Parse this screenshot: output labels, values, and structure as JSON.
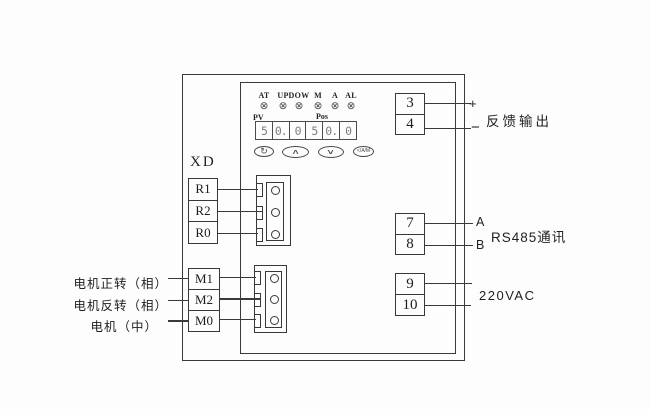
{
  "diagram": {
    "xd_label": "XD",
    "led_glyph": "⊗",
    "indicators": [
      "AT",
      "UP",
      "DOW",
      "M",
      "A",
      "AL"
    ],
    "display": {
      "pv_label": "PV",
      "pos_label": "Pos",
      "digits": [
        "5",
        "0.",
        "0",
        "5",
        "0.",
        "0"
      ]
    },
    "buttons": {
      "cycle": "↻",
      "up": "∧",
      "down": "∨",
      "am": "</A/M"
    },
    "relay_block": [
      "R1",
      "R2",
      "R0"
    ],
    "motor_block": [
      "M1",
      "M2",
      "M0"
    ],
    "motor_labels": [
      "电机正转（相）",
      "电机反转（相）",
      "电机（中）"
    ],
    "feedback": {
      "t_top": "3",
      "t_bottom": "4",
      "plus": "+",
      "minus": "−",
      "label": "反馈输出"
    },
    "rs485": {
      "t_top": "7",
      "t_bottom": "8",
      "a": "A",
      "b": "B",
      "label": "RS485通讯"
    },
    "power": {
      "t_top": "9",
      "t_bottom": "10",
      "label": "220VAC"
    }
  }
}
